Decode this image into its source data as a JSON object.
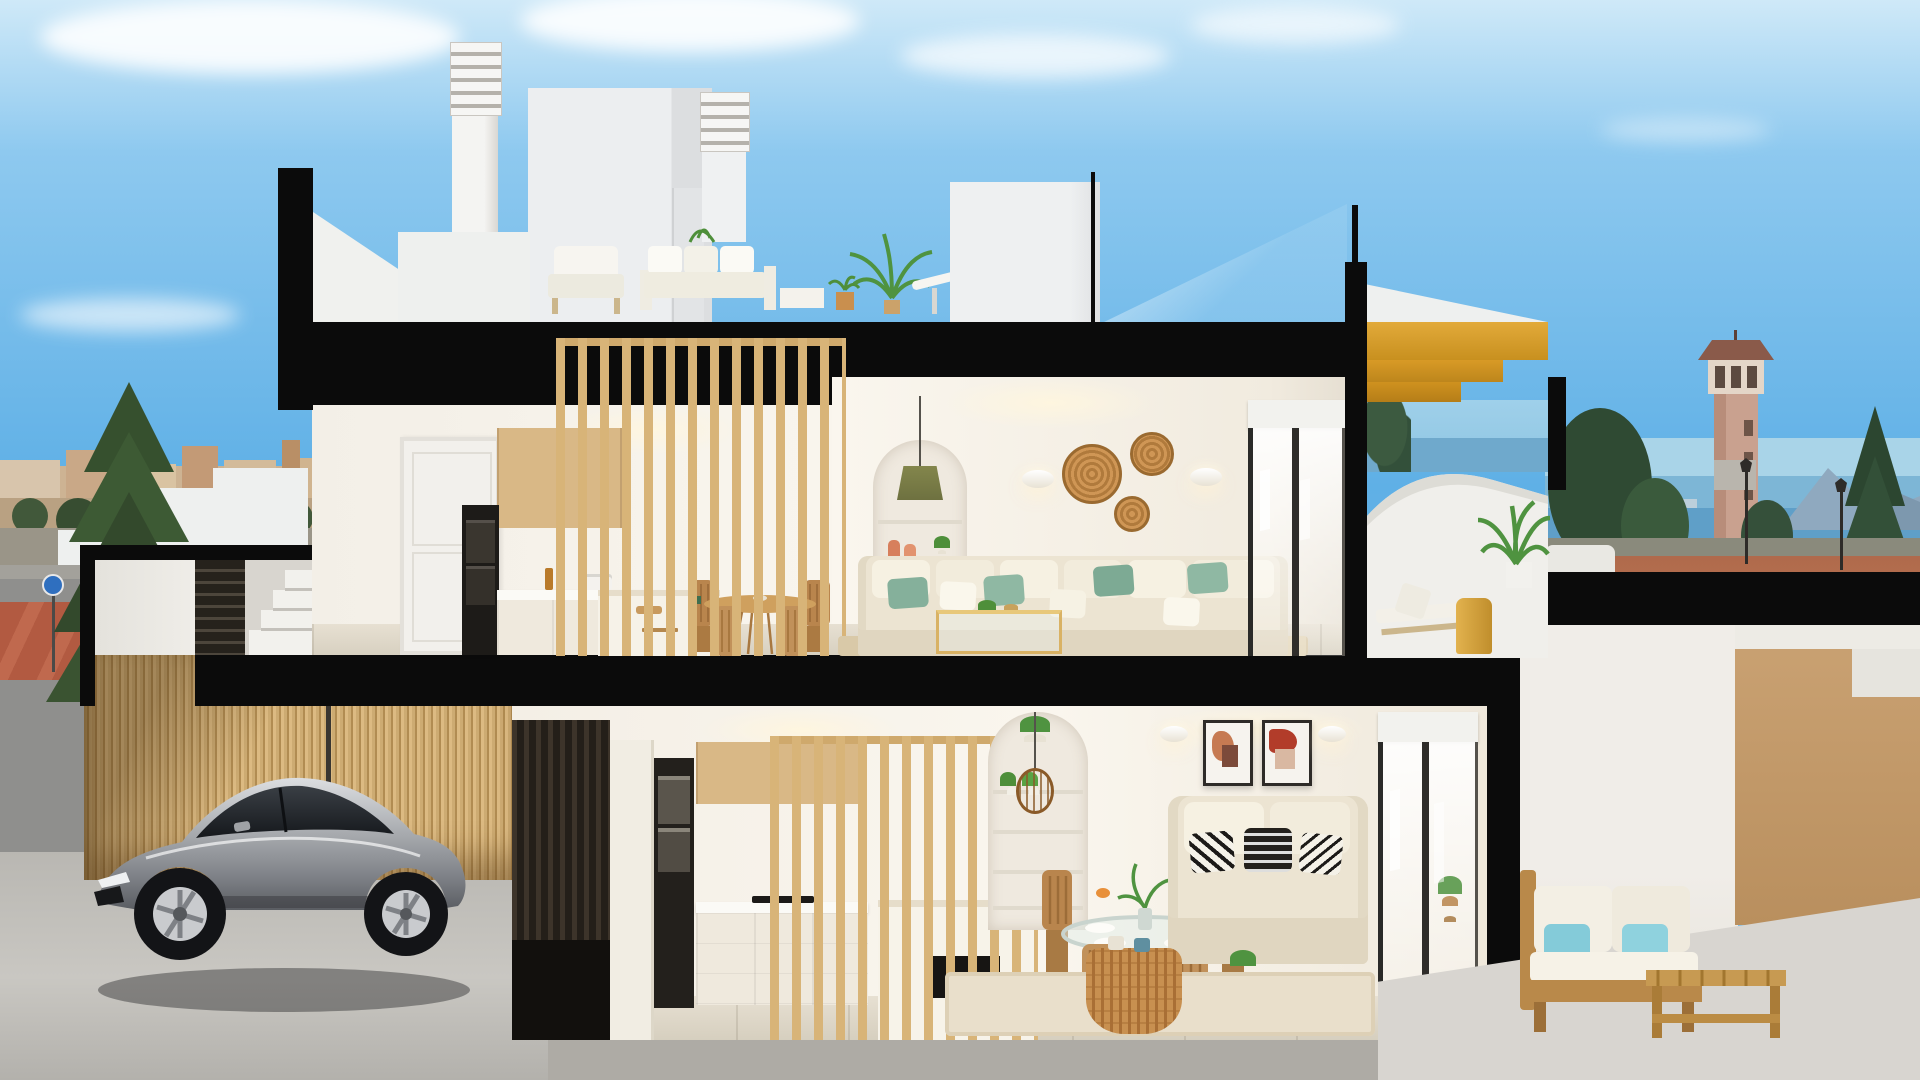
{
  "meta": {
    "title": "Cutaway cross-section 3D render of a modern two-storey coastal townhouse",
    "style": "architectural visualization, no on-screen text"
  },
  "palette": {
    "sky_top": "#cfe9f8",
    "sky_mid": "#5fb0e6",
    "cut_black": "#0b0b0b",
    "wall_white": "#f1f0ec",
    "interior_warm": "#f7f2ea",
    "wood_light": "#d9b886",
    "wood_gold": "#d89a26",
    "floor_tile": "#ddd6c8",
    "sofa_cream": "#ece4d2",
    "pillow_green": "#85b09b",
    "pillow_blue": "#84cbd9",
    "rattan": "#c98f4e",
    "sea": "#79b7d9",
    "ground_red": "#b06a4c",
    "bamboo_fence": "#c8a56d",
    "car_silver": "#a8abaf",
    "tan_ground": "#c09a6a",
    "tree_green": "#36502e"
  },
  "scene": {
    "sky": {
      "label": "Blue sky with soft scattered clouds"
    },
    "background": {
      "left_town": {
        "label": "Distant town with terracotta rooftops and green trees"
      },
      "left_street": {
        "label": "Street corner with red paved crossing and round traffic sign"
      },
      "left_tree": {
        "label": "Tall dark conifer tree"
      },
      "sea": {
        "label": "Sea with distant coastal skyline on the horizon"
      },
      "watchtower": {
        "label": "Sandstone watchtower with pyramid roof and open loggia"
      },
      "mountains": {
        "label": "Blue-grey headland across the bay"
      },
      "right_ground": {
        "label": "Red-earth esplanade with street lamps and low white walls"
      }
    },
    "roof": {
      "chimney_left": {
        "label": "White chimney with louvered cap"
      },
      "stair_bulkhead": {
        "label": "White rooftop stair bulkhead"
      },
      "chimney_right": {
        "label": "Second louvered chimney"
      },
      "terrace": {
        "label": "Roof terrace with white outdoor lounge set, coffee table and potted palms"
      },
      "glass_balustrade": {
        "label": "Frameless glass balustrade above the living room"
      },
      "wood_stair": {
        "label": "Golden timber stair descending to the upper terrace"
      }
    },
    "upper_floor": {
      "hall": {
        "label": "Hallway",
        "door": "White panel door with black lever handle"
      },
      "kitchen": {
        "label": "Oak kitchen with black oven column, white counters and island with stools"
      },
      "slat_screen": {
        "label": "Floor-to-ceiling light timber slat partition"
      },
      "dining": {
        "label": "Round timber dining table with four rattan chairs"
      },
      "niche": {
        "label": "Arched wall niche with shelves, terracotta vases and olive pendant lamp"
      },
      "living": {
        "label": "Cream sofa with sage-green cushions, glass-and-brass coffee table, striped rug"
      },
      "wall_decor": {
        "label": "Three woven rattan wall plates and two white sconces"
      },
      "sliding_door": {
        "label": "Glazed sliding door with white roller blind"
      },
      "terrace": {
        "label": "Curved white terrace with two loungers, brass drum table and potted palm overlooking the sea"
      }
    },
    "lower_floor": {
      "entry": {
        "label": "Street entry with plastered wall, dark louvered gate and white steps"
      },
      "garage": {
        "label": "Driveway and garage",
        "car": "Silver sports coupe parked before a bamboo-slat fence"
      },
      "kitchen": {
        "label": "Second kitchen with steel ovens, oak uppers and timber slat screen over island"
      },
      "dining": {
        "label": "Round glass dining table set for four with timber chairs"
      },
      "niche": {
        "label": "Arched shelf niche with plants and woven rattan pendant"
      },
      "living": {
        "label": "Cream sofa with black-and-white patterned cushions, rattan drum coffee table"
      },
      "art": {
        "label": "Two framed terracotta abstract prints"
      },
      "sliding_door": {
        "label": "Glazed sliding door to the patio"
      },
      "patio": {
        "label": "Timber outdoor sofa with white cushions and aqua pillows beside a slatted timber table"
      }
    }
  }
}
